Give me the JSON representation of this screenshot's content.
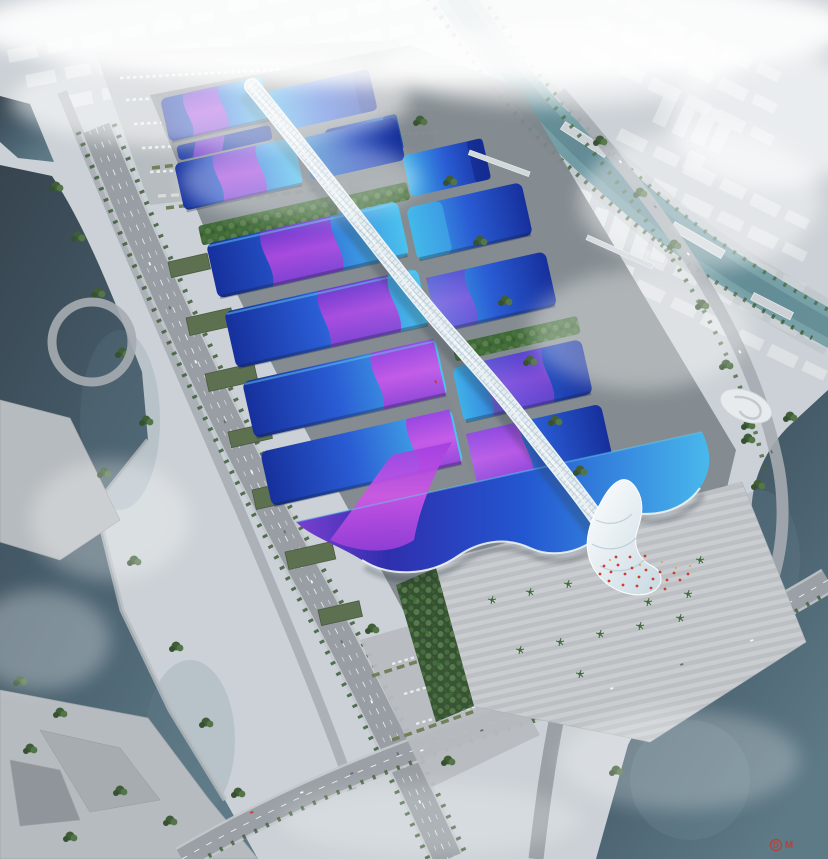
{
  "image": {
    "type": "aerial architectural rendering",
    "subject": "Riverside exhibition and convention center with wave-form blue roofs, magenta ribbon accents and a white serpentine central concourse, surrounded by expressways, rivers, a canal and a fog-washed city",
    "conditions": "hazy daylight"
  },
  "watermark": {
    "letter_primary": "D",
    "letter_secondary": "M",
    "color": "#c23a32"
  },
  "palette": {
    "ground_base": "#cbd1d6",
    "complex_apron": "#7e858b",
    "road": "#9aa0a5",
    "road_light": "#c3c8cc",
    "water_dark": "#31404e",
    "water_light": "#5c7682",
    "canal": "#6b96a0",
    "roof_navy": "#16309c",
    "roof_blue": "#2a5cd4",
    "roof_cyan": "#4cc2ee",
    "ribbon_magenta": "#c44fe0",
    "ribbon_purple": "#7736ce",
    "spine_white": "#edf3f6",
    "green_roof": "#5d7050",
    "tree_green": "#3f5e38",
    "plaza_gray": "#c6cacd",
    "accent_red": "#cf3a32",
    "haze_white": "#f4f6f7"
  },
  "scene": {
    "landmarks": [
      {
        "name": "central-spine-concourse",
        "desc": "white gridshell corridor running the length of the complex"
      },
      {
        "name": "exhibition-hall-roofs",
        "desc": "rows of blue gradient halls flanking the spine",
        "count": 13
      },
      {
        "name": "grand-south-hall",
        "desc": "large wave-edged hall at the south end with shell-shaped entrance canopy"
      },
      {
        "name": "entrance-plaza",
        "desc": "striped forecourt with palm trees and red banners"
      },
      {
        "name": "green-roof-strips",
        "desc": "landscaped planted strips between hall rows"
      },
      {
        "name": "north-parking-lot",
        "desc": "surface car park with bus bays"
      },
      {
        "name": "west-expressway",
        "desc": "elevated boulevard with interchange loop along the river"
      },
      {
        "name": "west-river",
        "desc": "broad dark river with terraced banks"
      },
      {
        "name": "east-canal",
        "desc": "tree-lined canal with bridges through the city"
      },
      {
        "name": "southeast-waterway",
        "desc": "canal basin crossed by the south boulevard"
      },
      {
        "name": "city-skyline",
        "desc": "fog-washed white city blocks and towers"
      }
    ]
  }
}
